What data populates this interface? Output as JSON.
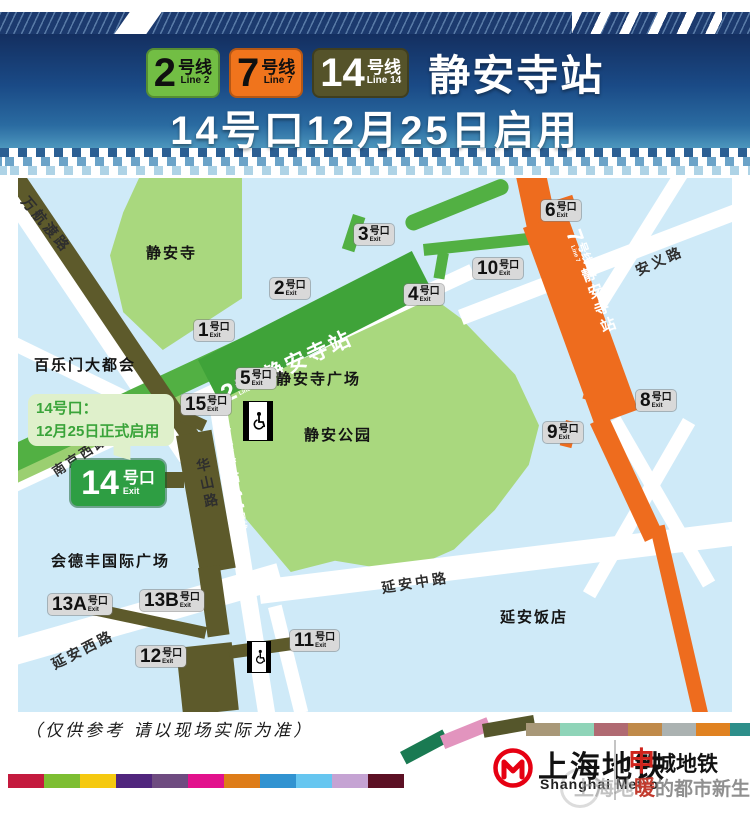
{
  "header": {
    "badges": [
      {
        "num": "2",
        "suffix": "号线",
        "latin": "Line 2"
      },
      {
        "num": "7",
        "suffix": "号线",
        "latin": "Line 7"
      },
      {
        "num": "14",
        "suffix": "号线",
        "latin": "Line 14"
      }
    ],
    "station": "静安寺站",
    "subtitle": "14号口12月25日启用"
  },
  "map": {
    "roads": {
      "wanhangdu": "万航渡路",
      "nanjingxi": "南京西路",
      "huashan": "华山路",
      "yananxi": "延安西路",
      "yananzhong": "延安中路",
      "anyi": "安义路"
    },
    "areas": {
      "jingansi": "静安寺",
      "bailemen": "百乐门大都会",
      "guangchang": "静安寺广场",
      "gongyuan": "静安公园",
      "huidefeng": "会德丰国际广场",
      "fandian": "延安饭店"
    },
    "lines": {
      "line2": {
        "num": "2",
        "suffix": "号线",
        "latin": "Line 2",
        "station": "静安寺站"
      },
      "line7": {
        "num": "7",
        "suffix": "号线",
        "latin": "Line 7",
        "station": "静安寺站"
      },
      "line14": {
        "num": "14",
        "suffix": "号线",
        "latin": "Line 14",
        "station": "静安寺站"
      }
    },
    "callout": {
      "line1": "14号口：",
      "line2": "12月25日正式启用"
    },
    "exit14": {
      "num": "14",
      "suffix": "号口",
      "exit": "Exit"
    },
    "exits": {
      "x1": {
        "num": "1",
        "suffix": "号口",
        "exit": "Exit"
      },
      "x2": {
        "num": "2",
        "suffix": "号口",
        "exit": "Exit"
      },
      "x3": {
        "num": "3",
        "suffix": "号口",
        "exit": "Exit"
      },
      "x4": {
        "num": "4",
        "suffix": "号口",
        "exit": "Exit"
      },
      "x5": {
        "num": "5",
        "suffix": "号口",
        "exit": "Exit"
      },
      "x6": {
        "num": "6",
        "suffix": "号口",
        "exit": "Exit"
      },
      "x8": {
        "num": "8",
        "suffix": "号口",
        "exit": "Exit"
      },
      "x9": {
        "num": "9",
        "suffix": "号口",
        "exit": "Exit"
      },
      "x10": {
        "num": "10",
        "suffix": "号口",
        "exit": "Exit"
      },
      "x11": {
        "num": "11",
        "suffix": "号口",
        "exit": "Exit"
      },
      "x12": {
        "num": "12",
        "suffix": "号口",
        "exit": "Exit"
      },
      "x13a": {
        "num": "13A",
        "suffix": "号口",
        "exit": "Exit"
      },
      "x13b": {
        "num": "13B",
        "suffix": "号口",
        "exit": "Exit"
      },
      "x15": {
        "num": "15",
        "suffix": "号口",
        "exit": "Exit"
      }
    }
  },
  "footer": {
    "note": "（仅供参考 请以现场实际为准）",
    "metro_cn": "上海地铁",
    "metro_en": "Shanghai Metro",
    "brand_red": "申",
    "brand_rest": "城地铁",
    "slogan_gray": "上海地",
    "slogan_red": "暖",
    "slogan_rest": "的都市新生活",
    "ribbon_bottom": [
      "#c41a3e",
      "#7dbe32",
      "#f5c90f",
      "#50267d",
      "#6e4b80",
      "#e2118c",
      "#de7c18",
      "#3193d1",
      "#66c6f0",
      "#c5a3d3",
      "#5c1024"
    ],
    "ribbon_curve": [
      "#1a7a52",
      "#e294be",
      "#55562b"
    ],
    "ribbon_top": [
      "#a89878",
      "#8fd4b8",
      "#b06a72",
      "#c08a4a",
      "#abb2b1",
      "#e08221",
      "#2e8f8a"
    ]
  },
  "colors": {
    "line2": "#52b043",
    "line2_station": "#3fa339",
    "line7": "#ee6c1e",
    "line14": "#5d5a2b",
    "badge2_bg": "#72be44",
    "badge7_bg": "#f0741c",
    "badge14_bg": "#55532a",
    "park": "#a9d87e",
    "water": "#cfeaf8",
    "exit_badge_bg": "#d9d9d9",
    "exit14_bg": "#2e9e43",
    "callout_bg": "#dff0cb",
    "callout_text": "#3aa43a",
    "header_navy": "#1c3a6e",
    "metro_logo_red": "#e60012"
  }
}
